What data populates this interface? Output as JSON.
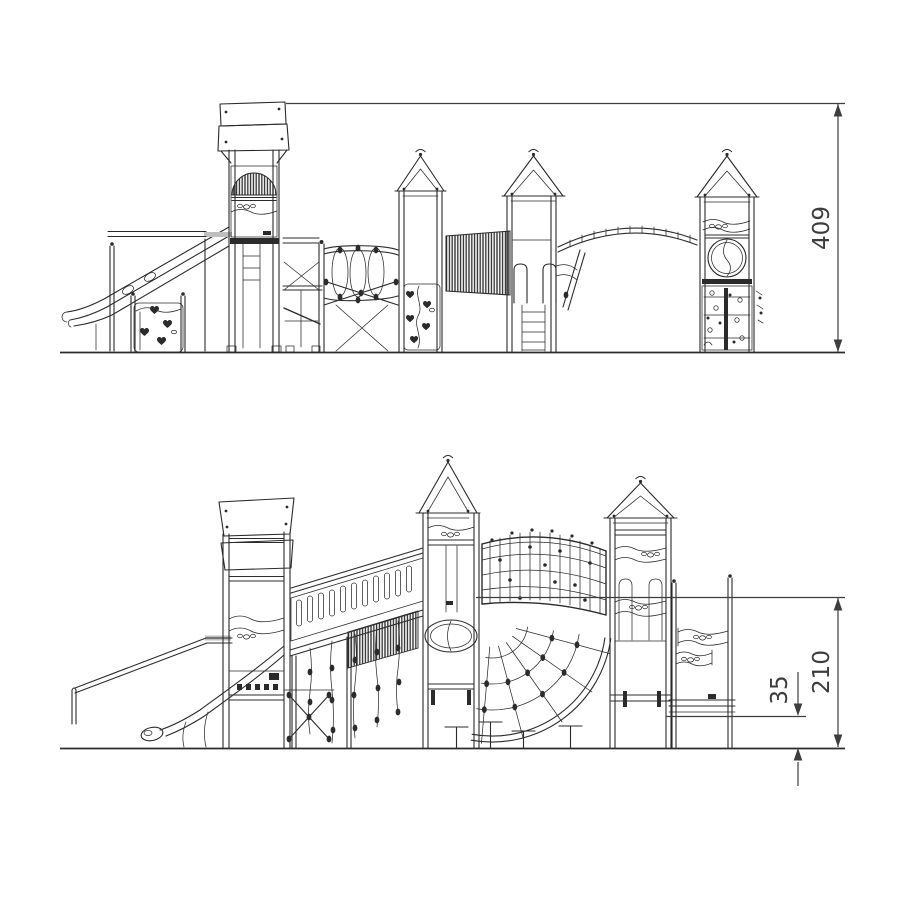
{
  "dims": {
    "overall_height": "409",
    "upper_height": "210",
    "lower_height": "35"
  },
  "colors": {
    "background": "#ffffff",
    "line": "#2b2b2b",
    "dimension": "#3d3d3d"
  }
}
